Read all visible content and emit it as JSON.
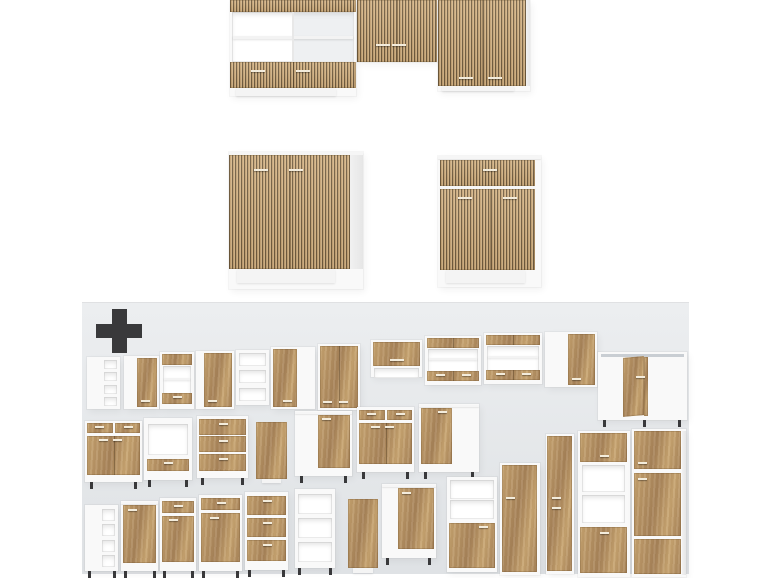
{
  "image": {
    "kind": "product-photo-collage",
    "subject": "kitchen-cabinet-set-with-additional-modules"
  },
  "colors": {
    "background": "#ffffff",
    "panel_top": "#eceef0",
    "panel_bottom": "#dfe2e5",
    "plus": "#39393b",
    "slat_light": "#d4b588",
    "slat_mid": "#c3a172",
    "slat_dark": "#6f5a3d",
    "oak_light": "#c9a672",
    "oak_dark": "#a8845a",
    "carcass": "#f9f9f9",
    "open_interior": "#ffffff",
    "handle": "#f3ecdc",
    "leg": "#39393b"
  },
  "icons": {
    "plus": "plus-icon"
  },
  "panel": {
    "x": 82,
    "y": 302,
    "w": 607,
    "h": 272,
    "plus": {
      "x": 96,
      "y": 309,
      "w": 46,
      "h": 44,
      "thickness": 15
    }
  },
  "scene": {
    "main_set": [
      {
        "k": "set-upper-left",
        "x": 230,
        "y": 0,
        "w": 126,
        "h": 96
      },
      {
        "k": "set-upper-mid",
        "x": 357,
        "y": 0,
        "w": 80,
        "h": 62
      },
      {
        "k": "set-upper-right",
        "x": 438,
        "y": 0,
        "w": 92,
        "h": 91
      },
      {
        "k": "sink-base",
        "x": 229,
        "y": 152,
        "w": 134,
        "h": 137
      },
      {
        "k": "drawer-base",
        "x": 438,
        "y": 156,
        "w": 103,
        "h": 131
      }
    ],
    "modules": [
      {
        "k": "cubbies",
        "x": 87,
        "y": 357,
        "w": 33,
        "h": 52,
        "n": 4
      },
      {
        "k": "wall-door",
        "x": 124,
        "y": 356,
        "w": 35,
        "h": 53,
        "side": "right",
        "frac": 0.62
      },
      {
        "k": "band-open-drawer",
        "x": 160,
        "y": 352,
        "w": 34,
        "h": 57,
        "drawers": 1
      },
      {
        "k": "wall-door",
        "x": 196,
        "y": 351,
        "w": 38,
        "h": 58,
        "side": "right",
        "frac": 0.8
      },
      {
        "k": "shelves",
        "x": 236,
        "y": 350,
        "w": 33,
        "h": 55,
        "n": 3
      },
      {
        "k": "wall-door",
        "x": 271,
        "y": 347,
        "w": 44,
        "h": 62,
        "side": "left",
        "frac": 0.6
      },
      {
        "k": "wall-door",
        "x": 318,
        "y": 344,
        "w": 42,
        "h": 66,
        "side": "full",
        "doors": 2
      },
      {
        "k": "lift-door",
        "x": 371,
        "y": 340,
        "w": 51,
        "h": 37
      },
      {
        "k": "band-open-drawer",
        "x": 425,
        "y": 336,
        "w": 56,
        "h": 49,
        "drawers": 2
      },
      {
        "k": "band-open-drawer",
        "x": 484,
        "y": 333,
        "w": 58,
        "h": 51,
        "drawers": 2
      },
      {
        "k": "wall-door",
        "x": 545,
        "y": 332,
        "w": 52,
        "h": 55,
        "side": "right",
        "frac": 0.55
      },
      {
        "k": "corner",
        "x": 598,
        "y": 352,
        "w": 89,
        "h": 68
      },
      {
        "k": "drawer-door-base",
        "x": 85,
        "y": 421,
        "w": 57,
        "h": 61,
        "cols": 2
      },
      {
        "k": "oven-open",
        "x": 144,
        "y": 418,
        "w": 48,
        "h": 62
      },
      {
        "k": "drawers3",
        "x": 197,
        "y": 416,
        "w": 51,
        "h": 62
      },
      {
        "k": "panel",
        "x": 255,
        "y": 422,
        "w": 33,
        "h": 62
      },
      {
        "k": "door-base",
        "x": 295,
        "y": 411,
        "w": 57,
        "h": 65,
        "side": "right",
        "frac": 0.6
      },
      {
        "k": "drawer-door-base",
        "x": 357,
        "y": 407,
        "w": 57,
        "h": 65,
        "cols": 2
      },
      {
        "k": "door-base",
        "x": 419,
        "y": 404,
        "w": 60,
        "h": 68,
        "side": "left",
        "frac": 0.55
      },
      {
        "k": "half-shelf-door",
        "x": 447,
        "y": 477,
        "w": 50,
        "h": 95
      },
      {
        "k": "tall-door",
        "x": 500,
        "y": 463,
        "w": 40,
        "h": 112
      },
      {
        "k": "tall-pantry",
        "x": 546,
        "y": 434,
        "w": 28,
        "h": 140
      },
      {
        "k": "tall-oven",
        "x": 578,
        "y": 431,
        "w": 52,
        "h": 146
      },
      {
        "k": "tall-fridge",
        "x": 632,
        "y": 429,
        "w": 54,
        "h": 148
      },
      {
        "k": "cubbies-base",
        "x": 85,
        "y": 505,
        "w": 33,
        "h": 66,
        "n": 4
      },
      {
        "k": "door-base",
        "x": 121,
        "y": 501,
        "w": 37,
        "h": 70,
        "side": "full",
        "frac": 1
      },
      {
        "k": "drawer-door-base",
        "x": 160,
        "y": 498,
        "w": 36,
        "h": 73,
        "cols": 1
      },
      {
        "k": "drawer-door-base",
        "x": 199,
        "y": 495,
        "w": 43,
        "h": 76,
        "cols": 1
      },
      {
        "k": "drawers3",
        "x": 245,
        "y": 492,
        "w": 43,
        "h": 78
      },
      {
        "k": "shelves-base",
        "x": 295,
        "y": 489,
        "w": 40,
        "h": 79,
        "n": 3
      },
      {
        "k": "panel",
        "x": 347,
        "y": 499,
        "w": 32,
        "h": 75
      },
      {
        "k": "door-base",
        "x": 382,
        "y": 484,
        "w": 54,
        "h": 74,
        "side": "right",
        "frac": 0.7
      }
    ]
  }
}
